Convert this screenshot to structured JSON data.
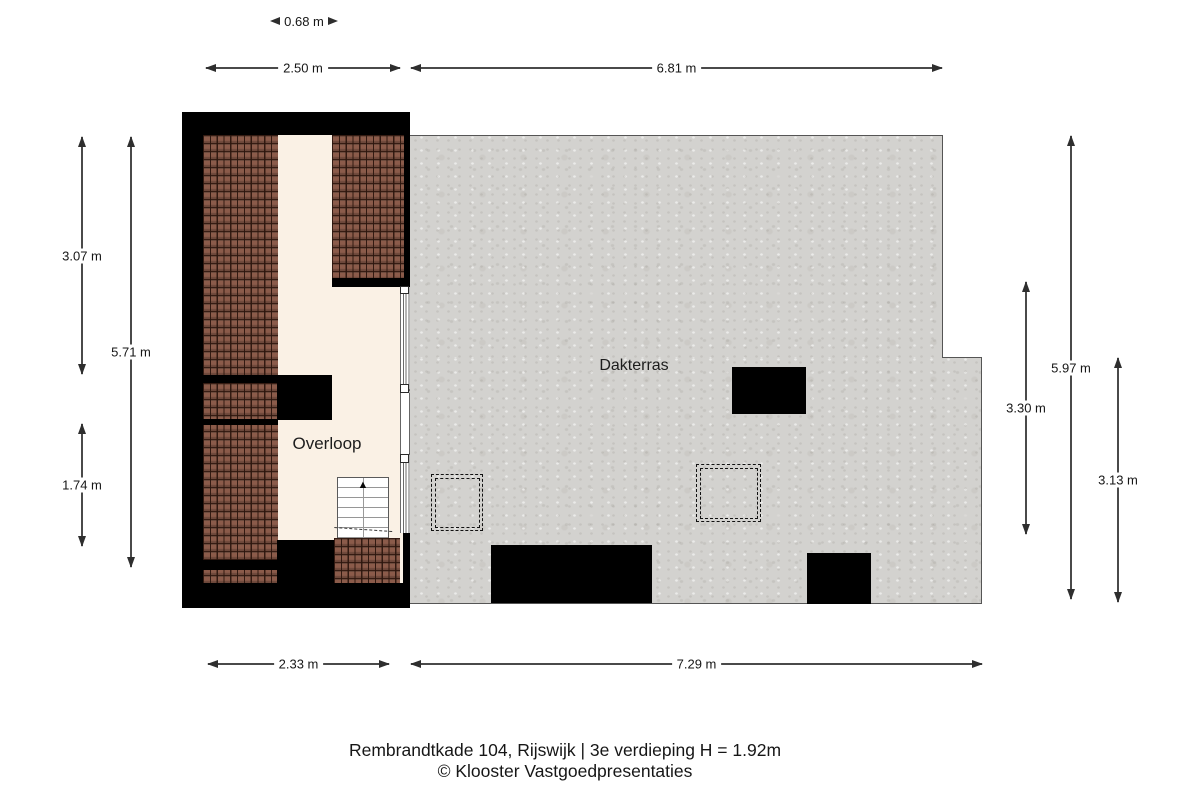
{
  "title": {
    "line1": "Rembrandtkade 104, Rijswijk | 3e verdieping H = 1.92m",
    "line2": "© Klooster Vastgoedpresentaties"
  },
  "rooms": {
    "overloop": "Overloop",
    "dakterras": "Dakterras"
  },
  "dimensions": {
    "corridor_width": "0.68 m",
    "top_left_width": "2.50 m",
    "top_right_width": "6.81 m",
    "bottom_left_width": "2.33 m",
    "bottom_right_width": "7.29 m",
    "left_upper_height": "3.07 m",
    "left_full_height": "5.71 m",
    "left_lower_height": "1.74 m",
    "right_terrace_height": "3.30 m",
    "right_full_height": "5.97 m",
    "right_lower_height": "3.13 m"
  },
  "icons": {
    "stairs_up_arrow": "▲"
  },
  "colors": {
    "wall": "#000000",
    "roof_tile": "#8b5b4a",
    "roof_tile_line": "#2b150d",
    "floor_cream": "#faf1e5",
    "terrace_gray": "#d3d2cf",
    "dimension_line": "#4a4a4a",
    "text": "#161616"
  }
}
